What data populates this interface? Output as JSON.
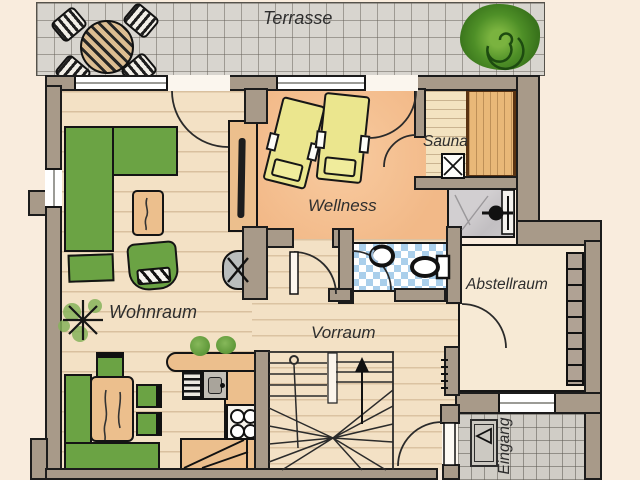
{
  "plan": {
    "type": "hand-drawn floor plan",
    "rooms": {
      "terrasse": "Terrasse",
      "wohnraum": "Wohnraum",
      "wellness": "Wellness",
      "sauna": "Sauna",
      "vorraum": "Vorraum",
      "abstellraum": "Abstellraum",
      "eingang": "Eingang"
    },
    "colors": {
      "background": "#f9ecdd",
      "wall_fill": "#a89a89",
      "outline": "#1c1c1c",
      "wood_floor": "#f3e1c5",
      "wellness_floor": "#f4bd90",
      "terrace_tile": "#d8d5cf",
      "entry_tile": "#d0cdc6",
      "furniture_green": "#6ba344",
      "lounger_yellow": "#ebe68e",
      "furniture_tan": "#ecbf8d",
      "wc_tile_blue": "#aacfeb",
      "shower_gray": "#cac7c9",
      "label_text": "#2e2e2e"
    },
    "furniture_icons": [
      "terrace-table-icon",
      "terrace-chair-icon",
      "bush-icon",
      "sofa",
      "ottoman",
      "coffee-table",
      "armchair",
      "houseplant-icon",
      "sideboard",
      "tv-icon",
      "wood-stove-icon",
      "corner-bench",
      "dining-table",
      "dining-chair",
      "kitchen-counter",
      "dishwasher-icon",
      "sink-icon",
      "cooktop-icon",
      "base-cabinet",
      "counter-plant-icon",
      "wellness-lounger",
      "sauna-bench",
      "sauna-heater-icon",
      "shower-head-icon",
      "wc-basin-icon",
      "toilet-icon",
      "staircase",
      "up-arrow-icon",
      "storage-shelf",
      "coat-hooks-icon",
      "doormat-icon",
      "door-arc"
    ]
  }
}
